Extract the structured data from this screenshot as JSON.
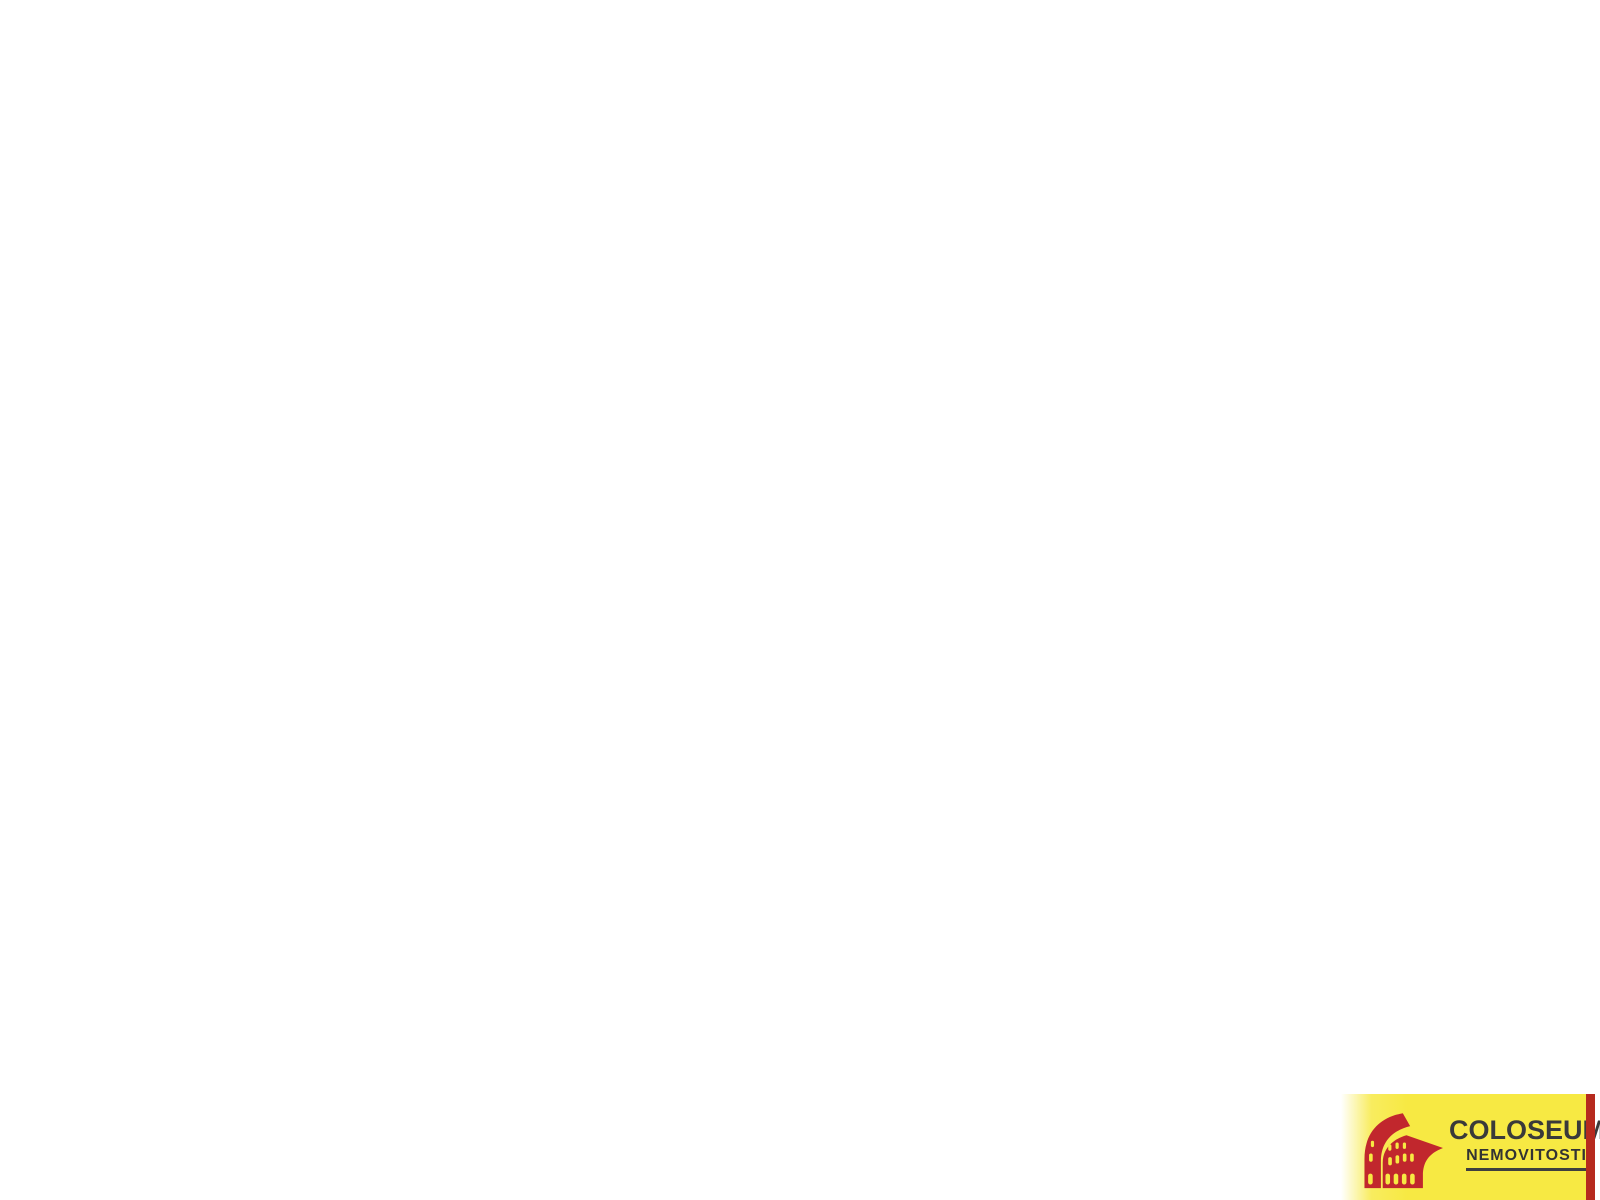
{
  "app": {
    "background": "#ffffff",
    "type": "3d-floorplan-render"
  },
  "logo": {
    "title": "COLOSEUM",
    "registered": "®",
    "subtitle": "NEMOVITOSTI",
    "colors": {
      "panel_yellow": "#f7e943",
      "stripe_red": "#b62a1e",
      "icon_red": "#c1272d",
      "text_dark": "#3a3a3a"
    }
  },
  "palette": {
    "background": "#ffffff",
    "wall_top": "#323232",
    "face_x": "#f2f2f2",
    "face_y": "#b9b9b9",
    "floor_khaki": "#d8d4a6",
    "floor_gray": "#c7c7c7",
    "floor_bath": "#cdcdcd",
    "glass": "#e4e2d8",
    "steel": "#c9cdd0",
    "white": "#fafafa",
    "saddle": "#e7e7e7"
  },
  "scene": {
    "projection": {
      "origin": [
        800,
        22
      ],
      "ux": 62,
      "uy": 50,
      "wallH": 76,
      "plinth": 0.5
    },
    "skirts": [
      {
        "name": "west-wall-skirt",
        "a": [
          -0.12,
          2.28
        ],
        "b": [
          -0.12,
          6.0
        ],
        "dx": -48,
        "dy": 72,
        "color": "#cfcfcf"
      },
      {
        "name": "living-west-skirt",
        "a": [
          1.58,
          6.32
        ],
        "b": [
          1.58,
          11.02
        ],
        "dx": -48,
        "dy": 72,
        "color": "#d4d4d4"
      },
      {
        "name": "block-west-skirt",
        "a": [
          2.48,
          -1.22
        ],
        "b": [
          2.48,
          0.64
        ],
        "dx": -38,
        "dy": 58,
        "color": "#d8d8d8"
      }
    ],
    "floors": [
      {
        "name": "bathroom-floor",
        "r": [
          0.2,
          2.6,
          3.45,
          4.5
        ],
        "color": "#cdcdcd"
      },
      {
        "name": "storage-room-floor",
        "r": [
          2.8,
          -0.9,
          3.9,
          0.5
        ],
        "color": "#c7c7c7"
      },
      {
        "name": "wc-room-floor",
        "r": [
          4.05,
          -0.9,
          5.1,
          0.5
        ],
        "color": "#c7c7c7"
      },
      {
        "name": "bedroom-floor",
        "r": [
          6.34,
          0.82,
          10.6,
          4.6
        ],
        "color": "#d8d4a6"
      },
      {
        "name": "hall-floor",
        "pts": [
          [
            2.8,
            0.64
          ],
          [
            5.42,
            0.64
          ],
          [
            5.42,
            0.82
          ],
          [
            6.06,
            0.82
          ],
          [
            6.06,
            4.5
          ],
          [
            3.6,
            4.5
          ],
          [
            3.6,
            2.28
          ],
          [
            2.8,
            2.28
          ]
        ],
        "color": "#c7c7c7"
      },
      {
        "name": "hall-floor-lower",
        "r": [
          4.54,
          4.5,
          6.06,
          6.0
        ],
        "color": "#c7c7c7"
      },
      {
        "name": "hall-floor-stub",
        "r": [
          6.06,
          4.92,
          7.6,
          6.0
        ],
        "color": "#c7c7c7"
      },
      {
        "name": "kitchen-floor",
        "r": [
          0.2,
          4.8,
          4.4,
          6.0
        ],
        "color": "#d8d4a6"
      },
      {
        "name": "living-room-floor",
        "r": [
          1.9,
          6.32,
          7.6,
          10.7
        ],
        "color": "#d8d4a6"
      }
    ],
    "walls": [
      {
        "name": "bathroom-north-wall",
        "r": [
          -0.12,
          2.28,
          3.6,
          2.6
        ],
        "fy": "#d9d9d9"
      },
      {
        "name": "west-exterior-wall",
        "r": [
          -0.12,
          2.28,
          0.2,
          6.0
        ],
        "fx": "#f4f4f4",
        "openings": [
          {
            "type": "window",
            "span": [
              3.35,
              4.3
            ]
          },
          {
            "type": "window",
            "span": [
              5.0,
              5.9
            ]
          }
        ]
      },
      {
        "name": "small-block-north-wall",
        "r": [
          2.48,
          -1.22,
          5.42,
          -0.9
        ],
        "fy": "#c6c6c6"
      },
      {
        "name": "small-block-west-wall",
        "r": [
          2.48,
          -1.22,
          2.8,
          0.64
        ],
        "fx": "#f1f1f1",
        "fy": "#f0f0f0"
      },
      {
        "name": "small-rooms-south-wall",
        "r": [
          2.8,
          0.5,
          5.42,
          0.64
        ],
        "fy": "#e8e8e8",
        "openings": [
          {
            "type": "door",
            "span": [
              3.1,
              3.7
            ],
            "mode": "closed"
          },
          {
            "type": "door",
            "span": [
              4.25,
              4.85
            ],
            "mode": "closed"
          }
        ]
      },
      {
        "name": "small-rooms-divider-wall",
        "r": [
          3.9,
          -0.9,
          4.05,
          0.5
        ],
        "fx": "#f1f1f1"
      },
      {
        "name": "small-block-east-wall",
        "r": [
          5.1,
          -1.22,
          5.42,
          0.5
        ],
        "fx": "#f4f4f4",
        "plinth": true
      },
      {
        "name": "bedroom-north-wall",
        "r": [
          5.42,
          0.5,
          10.92,
          0.82
        ],
        "fy": "#b4b4b4"
      },
      {
        "name": "bedroom-east-wall",
        "r": [
          10.6,
          0.82,
          10.92,
          4.92
        ],
        "fx": "#fafafa",
        "plinth": true,
        "openings": [
          {
            "type": "window",
            "span": [
              1.7,
              2.8
            ]
          },
          {
            "type": "window",
            "span": [
              3.55,
              4.65
            ]
          }
        ]
      },
      {
        "name": "bedroom-west-wall",
        "r": [
          6.06,
          0.82,
          6.34,
          4.92
        ],
        "fx": "#f3f3f3",
        "fy": "#ececec",
        "openings": [
          {
            "type": "door",
            "span": [
              3.72,
              4.48
            ],
            "mode": "closed"
          }
        ]
      },
      {
        "name": "bedroom-south-wall-inner",
        "r": [
          6.34,
          4.6,
          7.6,
          4.92
        ],
        "fy": "#f2f2f2"
      },
      {
        "name": "bedroom-south-wall-outer",
        "r": [
          7.6,
          4.6,
          10.92,
          4.92
        ],
        "fy": "#fafafa",
        "plinth": true
      },
      {
        "name": "bathroom-east-wall",
        "r": [
          3.45,
          2.6,
          3.6,
          4.5
        ],
        "fx": "#f1f1f1",
        "openings": [
          {
            "type": "door",
            "span": [
              2.95,
              3.75
            ],
            "mode": "open",
            "leaf": [
              [
                3.56,
                3.77
              ],
              [
                3.98,
                4.05
              ]
            ]
          }
        ]
      },
      {
        "name": "bathroom-kitchen-wall",
        "r": [
          0.2,
          4.5,
          4.54,
          4.8
        ],
        "fy": "#f7f7f7"
      },
      {
        "name": "kitchen-east-wall",
        "r": [
          4.4,
          4.8,
          4.54,
          6.0
        ],
        "fx": "#f1f1f1",
        "fy": "#f0f0f0",
        "openings": [
          {
            "type": "door",
            "span": [
              5.02,
              5.82
            ],
            "mode": "open",
            "leaf": [
              [
                4.5,
                5.84
              ],
              [
                4.92,
                5.52
              ]
            ]
          }
        ]
      },
      {
        "name": "south-exterior-wall-west",
        "r": [
          -0.12,
          6.0,
          1.58,
          6.32
        ],
        "fy": "#fafafa",
        "plinth": true
      },
      {
        "name": "living-north-wall",
        "r": [
          1.58,
          6.0,
          7.92,
          6.32
        ],
        "fy": "#f5f5f5",
        "openings": [
          {
            "type": "door",
            "span": [
              6.45,
              7.35
            ],
            "mode": "open",
            "leaf": [
              [
                7.39,
                6.38
              ],
              [
                7.53,
                7.28
              ]
            ]
          }
        ]
      },
      {
        "name": "living-west-wall",
        "r": [
          1.58,
          6.32,
          1.9,
          11.02
        ],
        "fx": "#f3f3f3",
        "openings": [
          {
            "type": "window",
            "span": [
              6.7,
              7.8
            ]
          }
        ]
      },
      {
        "name": "living-south-wall",
        "r": [
          1.58,
          10.7,
          7.92,
          11.02
        ],
        "fy": "#fafafa",
        "plinth": true,
        "openings": [
          {
            "type": "window",
            "span": [
              4.7,
              6.0
            ]
          }
        ]
      },
      {
        "name": "living-east-wall",
        "r": [
          7.6,
          6.32,
          7.92,
          10.7
        ],
        "fx": "#fafafa",
        "plinth": true,
        "openings": [
          {
            "type": "door",
            "span": [
              6.45,
              7.25
            ],
            "mode": "closed"
          },
          {
            "type": "window",
            "span": [
              7.9,
              8.95
            ]
          },
          {
            "type": "window",
            "span": [
              9.45,
              10.5
            ]
          }
        ]
      },
      {
        "name": "stub-east-wall",
        "r": [
          7.6,
          4.92,
          7.92,
          6.0
        ],
        "fx": "#f8f8f8",
        "fy": "#f0f0f0",
        "plinth": true
      }
    ],
    "fixtures": [
      {
        "type": "shower",
        "name": "shower-enclosure",
        "corner": [
          3.45,
          2.6
        ],
        "arc": [
          [
            2.5,
            2.6
          ],
          [
            2.627,
            3.075
          ],
          [
            2.975,
            3.423
          ],
          [
            3.45,
            3.55
          ]
        ],
        "tray_color": "#e9e9e9",
        "glass_h": 0.8
      },
      {
        "type": "bathsink",
        "name": "bathroom-sink",
        "r": [
          3.06,
          3.72,
          3.44,
          4.14
        ],
        "h1": 0.3,
        "h2": 0.45
      },
      {
        "type": "counter",
        "name": "kitchen-counter",
        "r": [
          0.5,
          4.8,
          3.55,
          5.42
        ],
        "h": 0.4,
        "seams": [
          1.15,
          1.8,
          3.0
        ],
        "sink": {
          "outer": [
            2.05,
            4.9,
            2.8,
            5.34
          ],
          "inner": [
            2.14,
            4.98,
            2.71,
            5.26
          ],
          "faucet": [
            2.42,
            4.88
          ]
        }
      },
      {
        "type": "fridge",
        "name": "fridge",
        "r": [
          3.6,
          4.8,
          4.38,
          5.52
        ],
        "h": 0.64
      }
    ]
  }
}
